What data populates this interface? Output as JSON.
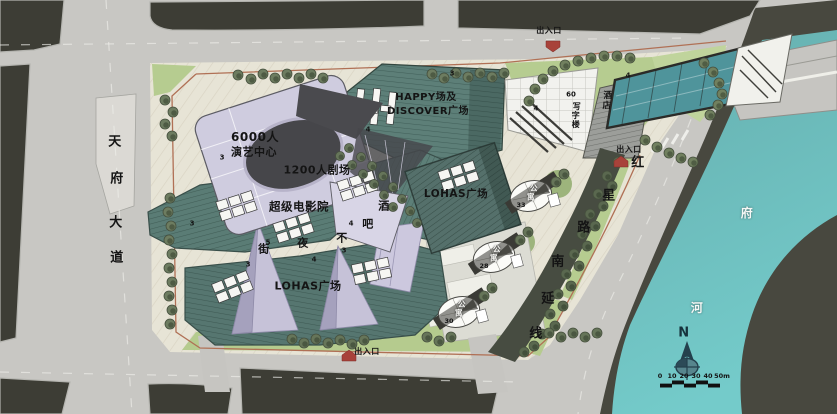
{
  "labels": {
    "road_left": "天府大道",
    "road_right": "红星路南延线",
    "river": "府河",
    "bar_street": "酒吧不夜街",
    "performing_center_line1": "6000人",
    "performing_center_line2": "演艺中心",
    "theater_1200": "1200人剧场",
    "cinema": "超级电影院",
    "happy_line1": "HAPPY场及",
    "happy_line2": "DISCOVER广场",
    "lohas_plaza_east": "LOHAS广场",
    "lohas_plaza_south": "LOHAS广场",
    "office_tower": "写字楼",
    "office_floors": "60",
    "hotel": "酒店",
    "apartment": "公寓",
    "apartment_floors": [
      "33",
      "28",
      "30"
    ],
    "entrance": "出入口",
    "floor_numbers": [
      "3",
      "4",
      "3",
      "4",
      "4",
      "3",
      "5",
      "3",
      "4",
      "3",
      "4"
    ],
    "north": "N",
    "scale_ticks": [
      "0",
      "10",
      "20",
      "30",
      "40",
      "50m"
    ]
  },
  "colors": {
    "road": "#c8c7c3",
    "city_block": "#3d3d35",
    "site_ground": "#e7e4d6",
    "lawn": "#b5cb8e",
    "roof_teal": "#5d7f78",
    "glass_lavender": "#c9c5da",
    "river": "#6fbcba",
    "bank": "#48483f",
    "entrance_red": "#a8423a",
    "boundary_red": "#b07055"
  }
}
